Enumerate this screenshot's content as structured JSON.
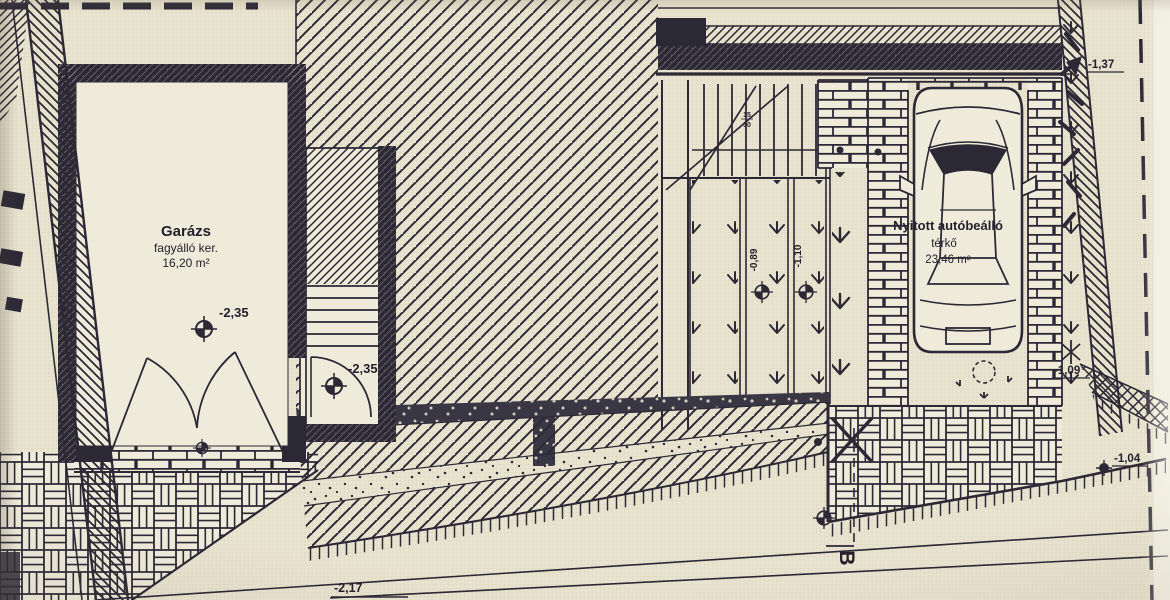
{
  "drawing": {
    "garage": {
      "title": "Garázs",
      "subtitle": "fagyálló ker.",
      "area": "16,20 m²",
      "level": "-2,35"
    },
    "stair_landing": {
      "level": "-2,35"
    },
    "stair_note": {
      "top": "15",
      "bottom": "30"
    },
    "carport": {
      "title": "Nyitott autóbeálló",
      "surface": "térkő",
      "area": "23,46 m²"
    },
    "levels": {
      "terrace_top": "-1,37",
      "carport_side": "-1,09",
      "driveway_edge": "-1,04",
      "ramp_bottom": "-2,17",
      "lawn_strip_a": "-0,89",
      "lawn_strip_b": "-1,10"
    },
    "section_marker": "B"
  },
  "colors": {
    "paper": "#e9e4cf",
    "paper_light": "#efebdb",
    "ink": "#2c2936"
  }
}
